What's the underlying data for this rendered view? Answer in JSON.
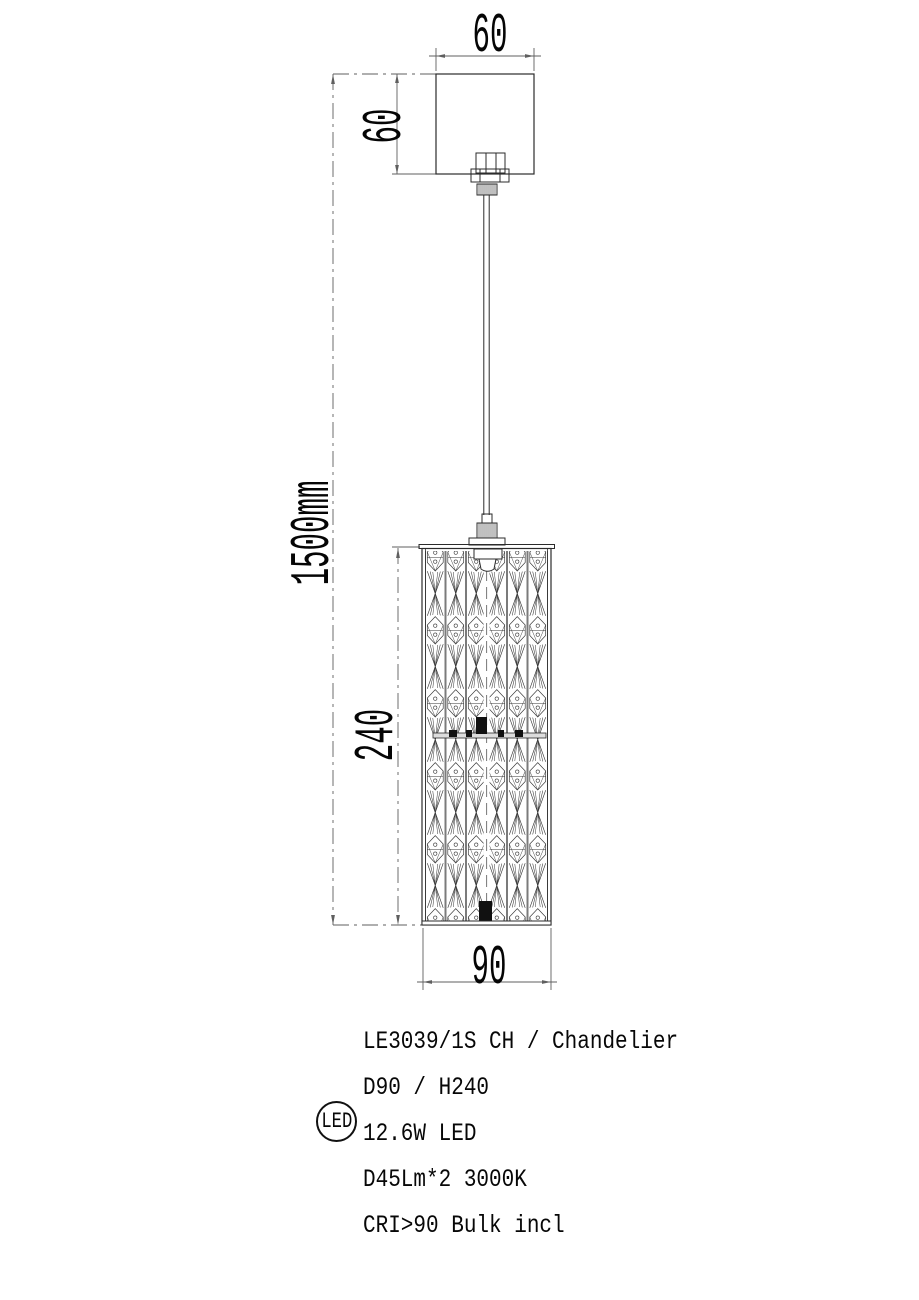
{
  "drawing": {
    "title": "Pendant chandelier technical drawing",
    "dimensions": {
      "canopy_width": "60",
      "canopy_height": "60",
      "suspension_length": "1500mm",
      "shade_height": "240",
      "shade_diameter": "90"
    },
    "colors": {
      "object_line": "#2b2b2b",
      "dimension_line": "#5f5f5f",
      "pattern_line": "#333333",
      "text": "#070707",
      "background": "#ffffff"
    }
  },
  "spec": {
    "badge": "LED",
    "lines": [
      "LE3039/1S CH / Chandelier",
      "D90 / H240",
      "12.6W LED",
      "D45Lm*2  3000K",
      "CRI>90 Bulk incl"
    ]
  }
}
